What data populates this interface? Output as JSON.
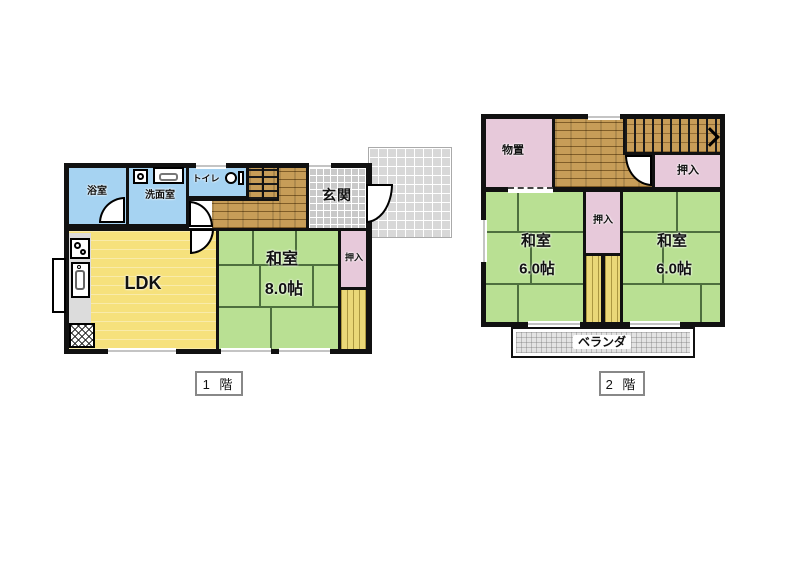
{
  "floor1": {
    "label": "1 階",
    "bath": "浴室",
    "washroom": "洗面室",
    "toilet": "トイレ",
    "entrance": "玄関",
    "ldk": "LDK",
    "washitsu": "和室",
    "washitsu_size": "8.0帖",
    "closet": "押入"
  },
  "floor2": {
    "label": "2 階",
    "storage": "物置",
    "closet_top": "押入",
    "closet_mid": "押入",
    "washitsu_left": "和室",
    "washitsu_left_size": "6.0帖",
    "washitsu_right": "和室",
    "washitsu_right_size": "6.0帖",
    "veranda": "ベランダ"
  },
  "colors": {
    "wall": "#111111",
    "water_rooms_blue": "#a6d3f2",
    "ldk_yellow": "#f6e17c",
    "tatami_green": "#b9e093",
    "closet_pink": "#e7c9da",
    "wood_floor": "#c79d58",
    "engawa_yellow": "#ead878",
    "entrance_tile": "#c9c9c9",
    "approach_tile": "#d8d8d8",
    "veranda_gray": "#e3e3e3"
  }
}
